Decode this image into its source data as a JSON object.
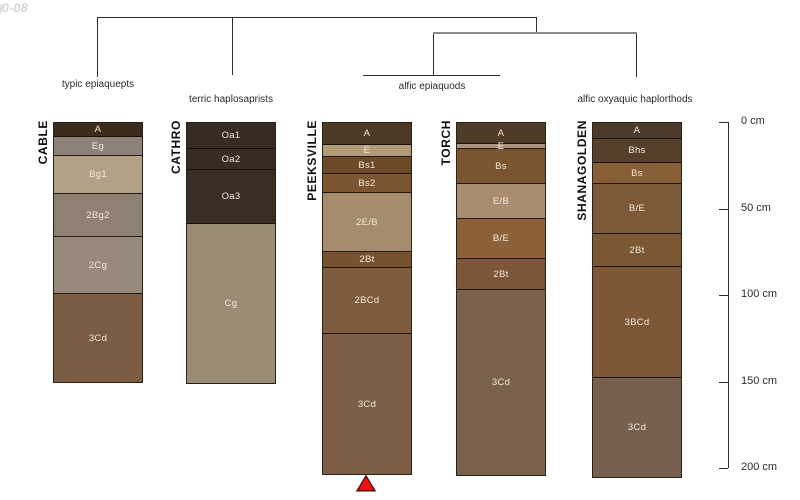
{
  "watermark": "0-08",
  "colors": {
    "tree_line": "#2d2d2d",
    "tree_line_gray": "#8a8a8a",
    "axis": "#2d2d2d",
    "horizon_border": "#241b10",
    "horizon_label": "#efe8da",
    "marker_red": "#ee1111",
    "watermark_gray": "#c4c4c4"
  },
  "chart_data": {
    "type": "soil-profile-dendrogram",
    "depth_axis": {
      "unit": "cm",
      "ticks": [
        0,
        50,
        100,
        150,
        200
      ],
      "tick_labels": [
        "0 cm",
        "50 cm",
        "100 cm",
        "150 cm",
        "200 cm"
      ],
      "max_depth_cm": 200
    },
    "clusters": [
      {
        "label": "typic epiaquepts",
        "profiles": [
          "CABLE"
        ]
      },
      {
        "label": "terric haplosaprists",
        "profiles": [
          "CATHRO"
        ]
      },
      {
        "label": "alfic epiaquods",
        "profiles": [
          "PEEKSVILLE",
          "TORCH"
        ]
      },
      {
        "label": "alfic oxyaquic haplorthods",
        "profiles": [
          "SHANAGOLDEN"
        ]
      }
    ],
    "profiles": [
      {
        "name": "CABLE",
        "horizons": [
          {
            "label": "A",
            "top_cm": 0,
            "bottom_cm": 8,
            "color": "#3b2c1d"
          },
          {
            "label": "Eg",
            "top_cm": 8,
            "bottom_cm": 19,
            "color": "#8d8277"
          },
          {
            "label": "Bg1",
            "top_cm": 19,
            "bottom_cm": 41,
            "color": "#b2a186"
          },
          {
            "label": "2Bg2",
            "top_cm": 41,
            "bottom_cm": 66,
            "color": "#8e8072"
          },
          {
            "label": "2Cg",
            "top_cm": 66,
            "bottom_cm": 99,
            "color": "#97897b"
          },
          {
            "label": "3Cd",
            "top_cm": 99,
            "bottom_cm": 150,
            "color": "#7b5b41"
          }
        ]
      },
      {
        "name": "CATHRO",
        "horizons": [
          {
            "label": "Oa1",
            "top_cm": 0,
            "bottom_cm": 15,
            "color": "#372b23"
          },
          {
            "label": "Oa2",
            "top_cm": 15,
            "bottom_cm": 27,
            "color": "#372b23"
          },
          {
            "label": "Oa3",
            "top_cm": 27,
            "bottom_cm": 58,
            "color": "#392d24"
          },
          {
            "label": "Cg",
            "top_cm": 58,
            "bottom_cm": 150,
            "color": "#9a8c75"
          }
        ]
      },
      {
        "name": "PEEKSVILLE",
        "horizons": [
          {
            "label": "A",
            "top_cm": 0,
            "bottom_cm": 13,
            "color": "#4c3a26"
          },
          {
            "label": "E",
            "top_cm": 13,
            "bottom_cm": 20,
            "color": "#b39a79"
          },
          {
            "label": "Bs1",
            "top_cm": 20,
            "bottom_cm": 30,
            "color": "#6c4a27"
          },
          {
            "label": "Bs2",
            "top_cm": 30,
            "bottom_cm": 41,
            "color": "#7c5630"
          },
          {
            "label": "2E/B",
            "top_cm": 41,
            "bottom_cm": 75,
            "color": "#a58c6c"
          },
          {
            "label": "2Bt",
            "top_cm": 75,
            "bottom_cm": 84,
            "color": "#78512e"
          },
          {
            "label": "2BCd",
            "top_cm": 84,
            "bottom_cm": 122,
            "color": "#7d5b3d"
          },
          {
            "label": "3Cd",
            "top_cm": 122,
            "bottom_cm": 203,
            "color": "#7c5d45"
          }
        ]
      },
      {
        "name": "TORCH",
        "horizons": [
          {
            "label": "A",
            "top_cm": 0,
            "bottom_cm": 12,
            "color": "#4e3b28"
          },
          {
            "label": "E",
            "top_cm": 12,
            "bottom_cm": 15,
            "color": "#a9947d"
          },
          {
            "label": "Bs",
            "top_cm": 15,
            "bottom_cm": 35,
            "color": "#7b5530"
          },
          {
            "label": "E/B",
            "top_cm": 35,
            "bottom_cm": 55,
            "color": "#aa8d70"
          },
          {
            "label": "B/E",
            "top_cm": 55,
            "bottom_cm": 78,
            "color": "#8c613a"
          },
          {
            "label": "2Bt",
            "top_cm": 78,
            "bottom_cm": 96,
            "color": "#7d563a"
          },
          {
            "label": "3Cd",
            "top_cm": 96,
            "bottom_cm": 203,
            "color": "#7a614b"
          }
        ]
      },
      {
        "name": "SHANAGOLDEN",
        "horizons": [
          {
            "label": "A",
            "top_cm": 0,
            "bottom_cm": 9,
            "color": "#4c3b2a"
          },
          {
            "label": "Bhs",
            "top_cm": 9,
            "bottom_cm": 23,
            "color": "#56402b"
          },
          {
            "label": "Bs",
            "top_cm": 23,
            "bottom_cm": 35,
            "color": "#875e35"
          },
          {
            "label": "B/E",
            "top_cm": 35,
            "bottom_cm": 64,
            "color": "#7d5a37"
          },
          {
            "label": "2Bt",
            "top_cm": 64,
            "bottom_cm": 83,
            "color": "#7c5733"
          },
          {
            "label": "3BCd",
            "top_cm": 83,
            "bottom_cm": 147,
            "color": "#7e5737"
          },
          {
            "label": "3Cd",
            "top_cm": 147,
            "bottom_cm": 204,
            "color": "#786050"
          }
        ]
      },
      {
        "name": "marker-note",
        "horizons": []
      }
    ],
    "marker": {
      "shape": "triangle-up",
      "profile": "PEEKSVILLE",
      "color": "#ee1111"
    }
  }
}
